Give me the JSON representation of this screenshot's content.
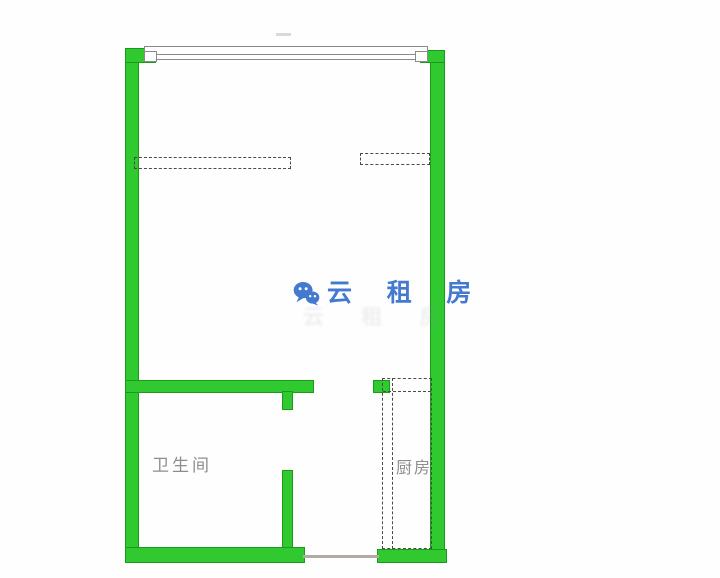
{
  "image": {
    "type": "floor-plan"
  },
  "watermark": {
    "brand": "云 租 房",
    "ghost_text": "云 租 房",
    "icon": "wechat-chat-bubbles-icon"
  },
  "rooms": {
    "bathroom": {
      "label": "卫生间"
    },
    "kitchen": {
      "label": "厨房"
    }
  },
  "colors": {
    "wall_fill": "#30c930",
    "wall_edge": "#1a9c1a",
    "window_line": "#8a8a8a",
    "dashed_line": "#4a4a4a",
    "label_text": "#8d8d8d",
    "watermark_blue": "#4479d0",
    "threshold": "#b0aba5"
  }
}
